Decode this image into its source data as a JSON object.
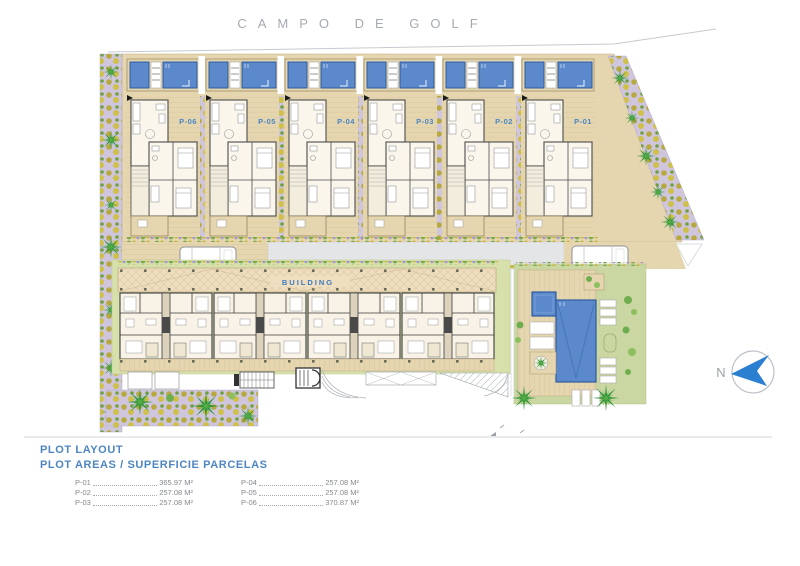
{
  "title": "CAMPO DE GOLF",
  "plan": {
    "building_label": "BUILDING",
    "north_label": "N",
    "units": [
      {
        "label": "P-06"
      },
      {
        "label": "P-05"
      },
      {
        "label": "P-04"
      },
      {
        "label": "P-03"
      },
      {
        "label": "P-02"
      },
      {
        "label": "P-01"
      }
    ]
  },
  "legend": {
    "heading_1": "PLOT LAYOUT",
    "heading_2": "PLOT AREAS / SUPERFICIE PARCELAS",
    "columns": [
      {
        "rows": [
          {
            "label": "P-01",
            "value": "365.97 M²"
          },
          {
            "label": "P-02",
            "value": "257.08 M²"
          },
          {
            "label": "P-03",
            "value": "257.08 M²"
          }
        ]
      },
      {
        "rows": [
          {
            "label": "P-04",
            "value": "257.08 M²"
          },
          {
            "label": "P-05",
            "value": "257.08 M²"
          },
          {
            "label": "P-06",
            "value": "370.87 M²"
          }
        ]
      }
    ]
  },
  "colors": {
    "pool_blue": "#5c89cb",
    "pool_blue_dark": "#2e5c9e",
    "deck_tan": "#e6d6b0",
    "lawn_green": "#cbd7a2",
    "hedge_green": "#d7e0ab",
    "planting_lavender": "#cfc6dd",
    "palm_green": "#2f9138",
    "road_gray": "#e4e5e7",
    "accent_blue": "#4a86c5",
    "title_gray": "#a4aab2"
  }
}
